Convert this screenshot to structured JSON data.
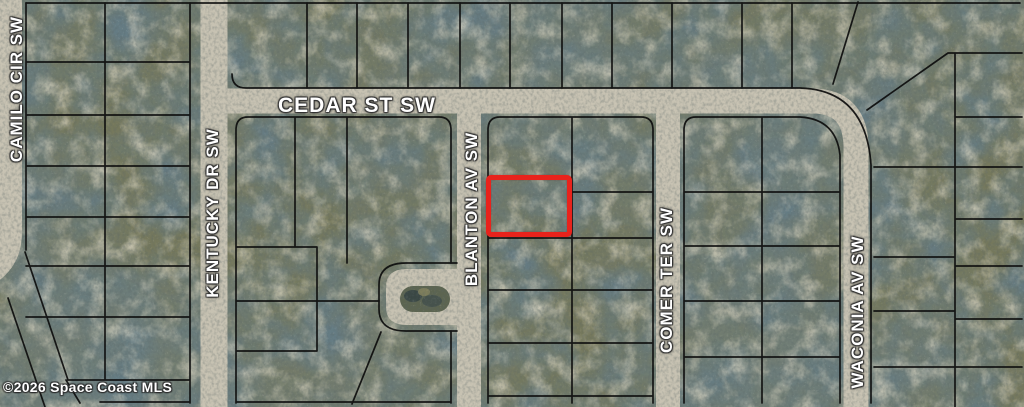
{
  "map": {
    "streets": [
      {
        "name": "CAMILO CIR SW",
        "orientation": "vertical"
      },
      {
        "name": "KENTUCKY DR SW",
        "orientation": "vertical"
      },
      {
        "name": "CEDAR ST SW",
        "orientation": "horizontal"
      },
      {
        "name": "BLANTON AV SW",
        "orientation": "vertical"
      },
      {
        "name": "COMER TER SW",
        "orientation": "vertical"
      },
      {
        "name": "WACONIA AV SW",
        "orientation": "vertical"
      }
    ],
    "highlight": {
      "color": "#e8231c"
    },
    "copyright": "©2026 Space Coast MLS"
  }
}
